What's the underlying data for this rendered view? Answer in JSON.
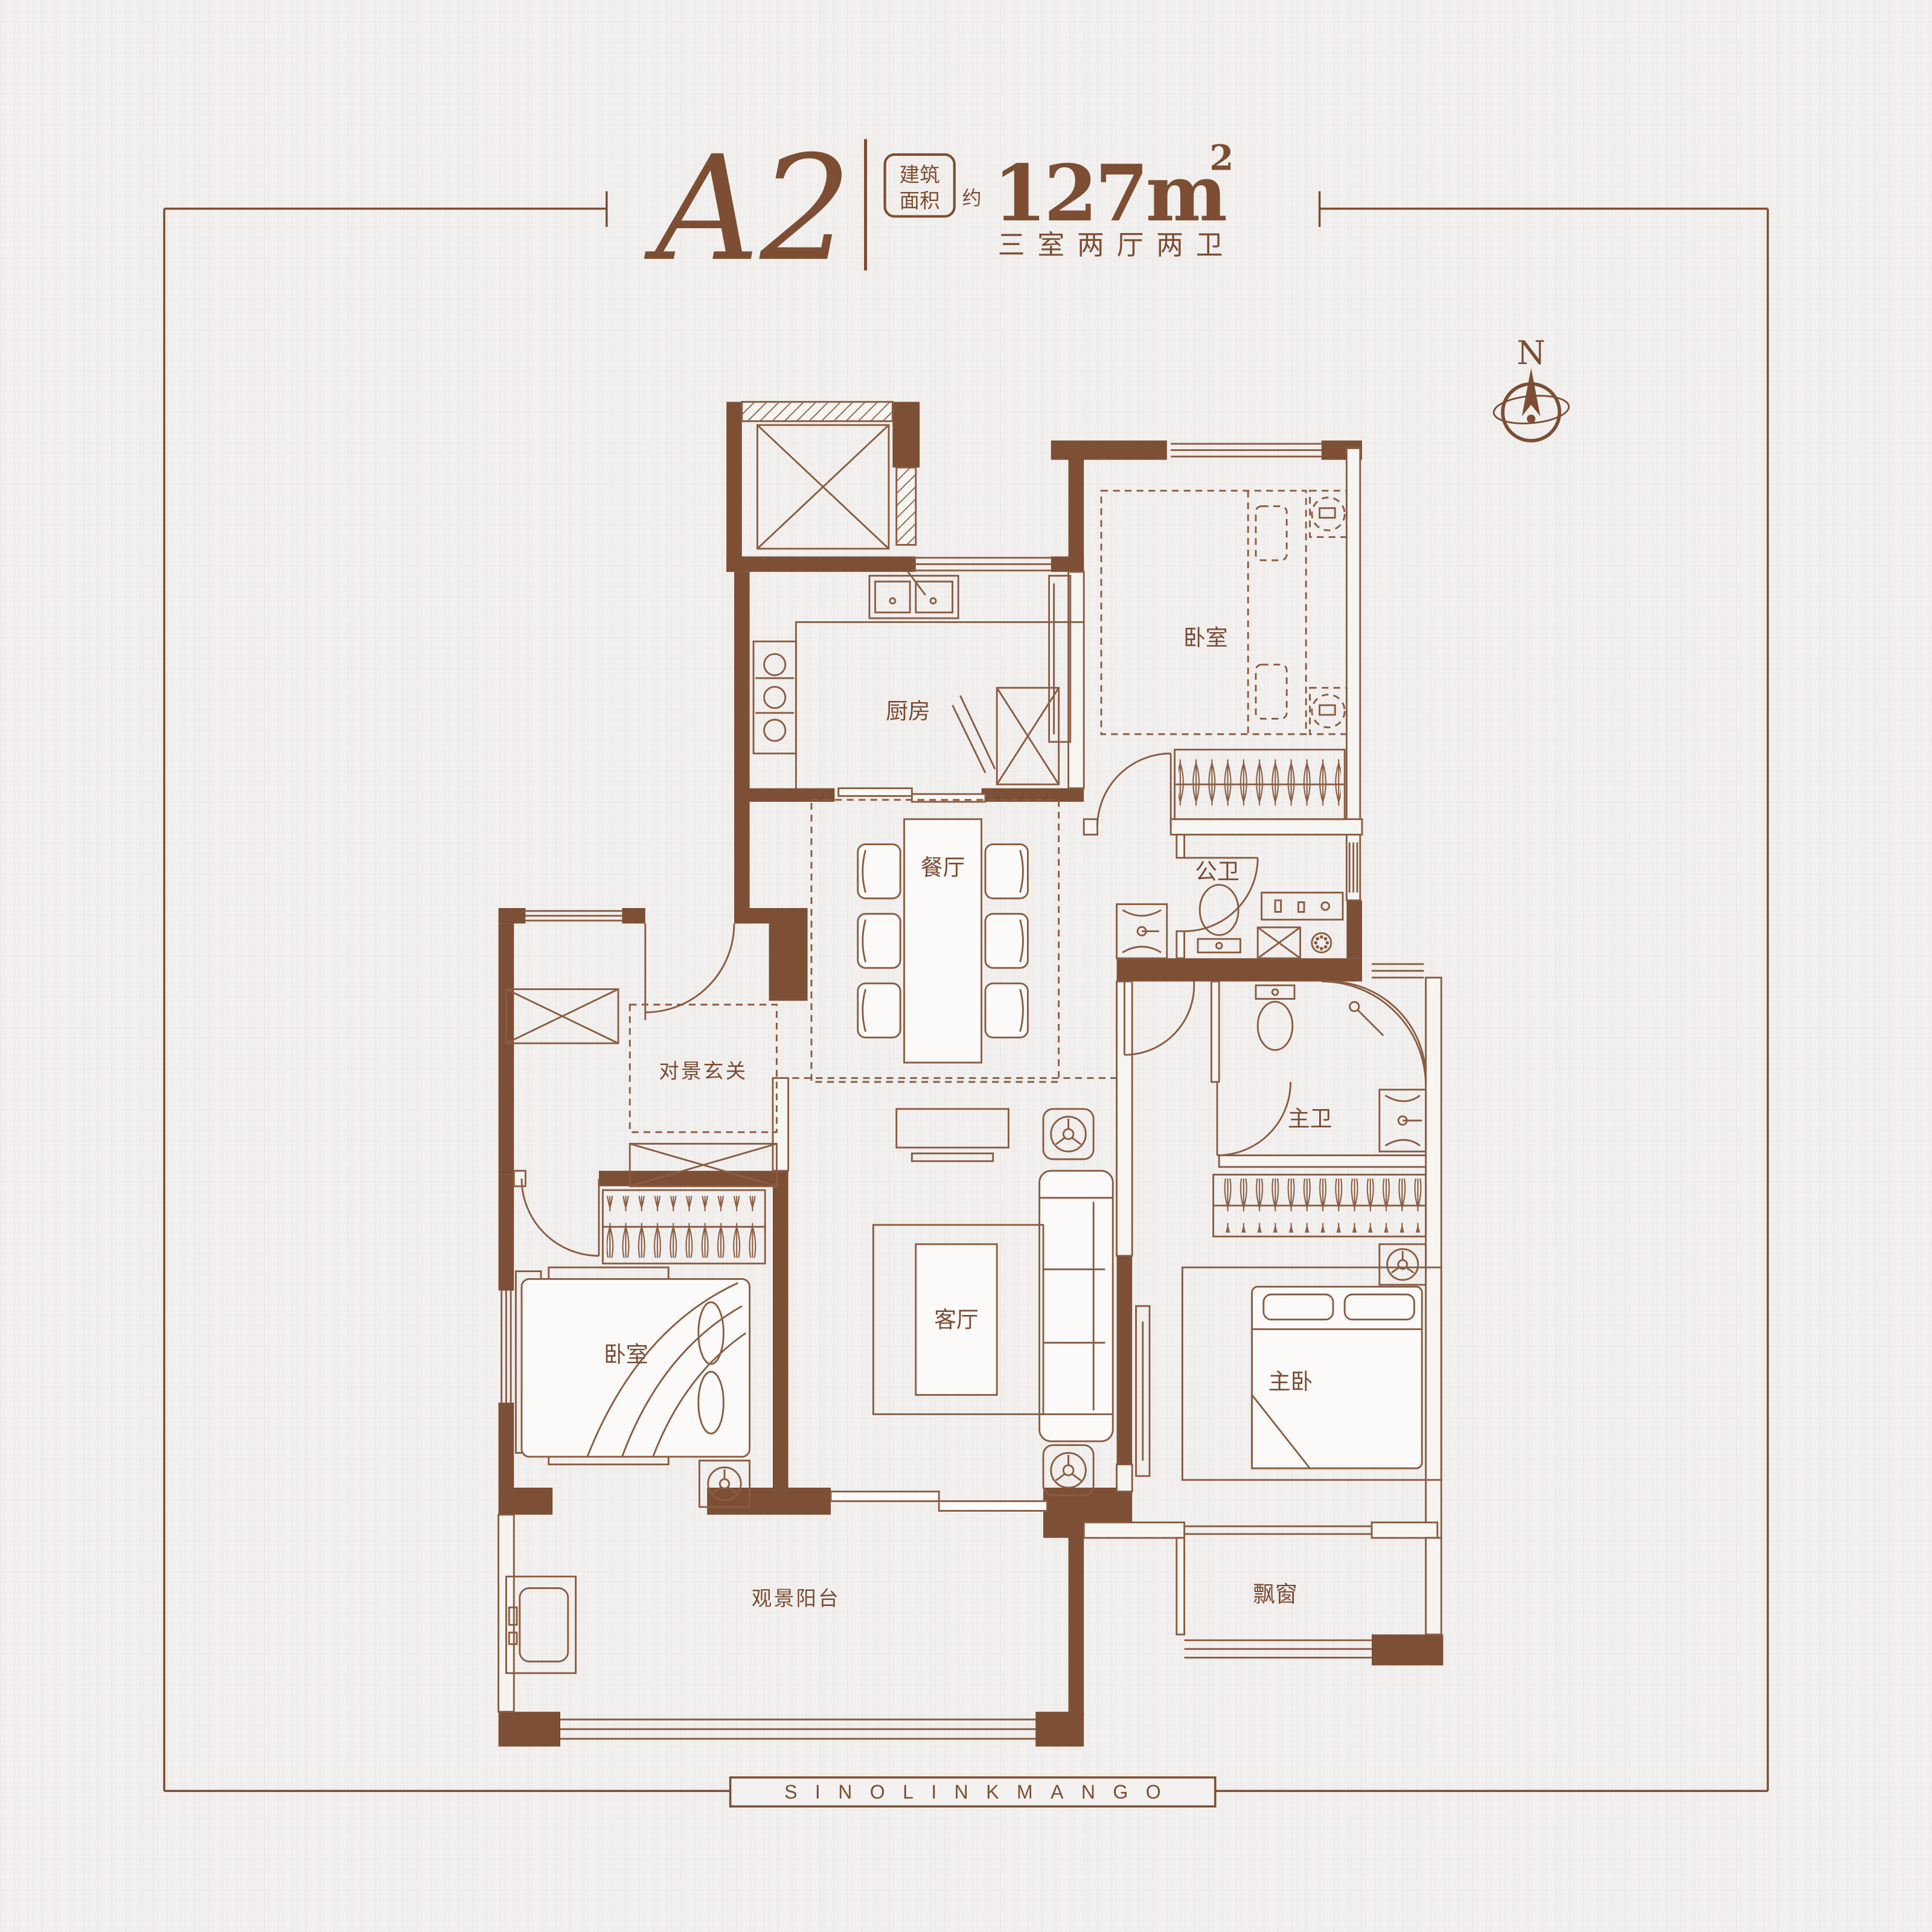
{
  "title": {
    "unit": "A2",
    "area_box": [
      "建筑",
      "面积"
    ],
    "approx": "约",
    "area": "127m",
    "area_exp": "2",
    "layout": "三室两厅两卫"
  },
  "compass": {
    "north": "N"
  },
  "rooms": {
    "kitchen": "厨房",
    "bedroom_north": "卧室",
    "dining": "餐厅",
    "guest_bath": "公卫",
    "foyer": "对景玄关",
    "living": "客厅",
    "master_bath": "主卫",
    "bedroom_west": "卧室",
    "master_bedroom": "主卧",
    "balcony": "观景阳台",
    "bay_window": "飘窗"
  },
  "footer": {
    "brand": "SINOLINKMANGO"
  },
  "colors": {
    "wall": "#7d4f35",
    "line": "#8a5c42",
    "text": "#7a4b33",
    "accent": "#7d4e33",
    "background": "#f2f0ee"
  }
}
